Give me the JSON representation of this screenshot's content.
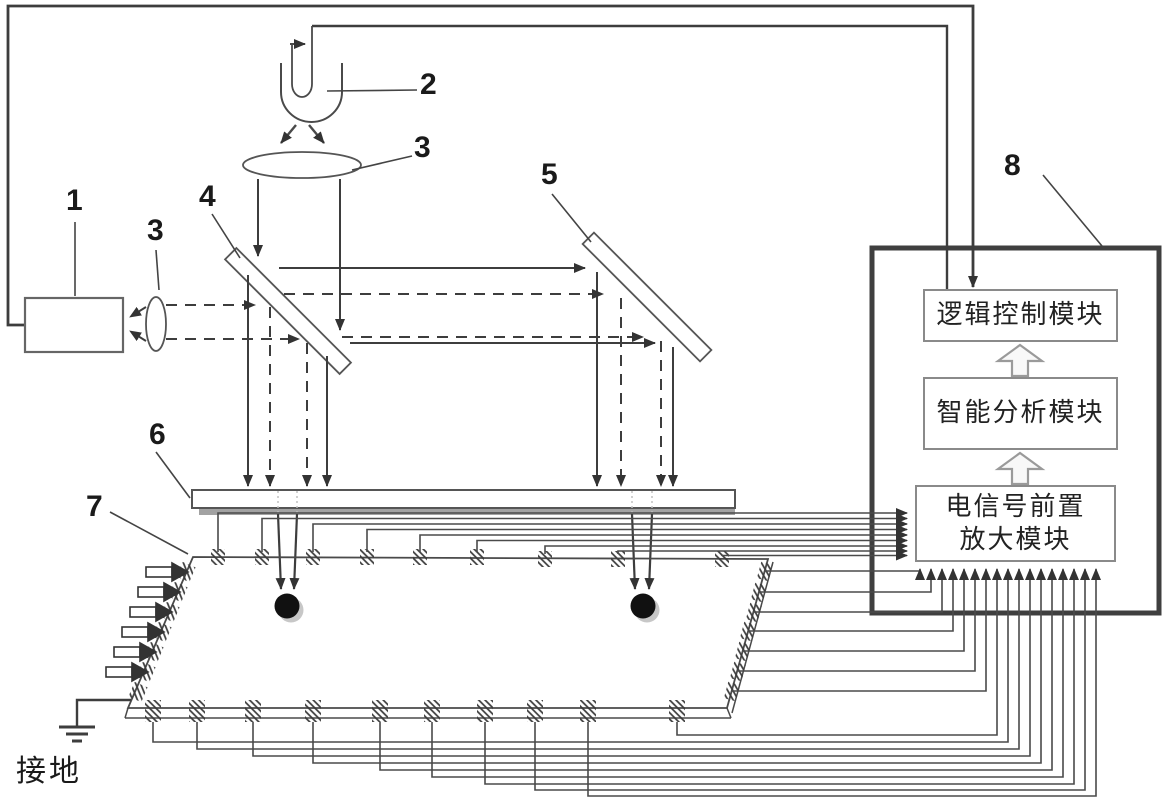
{
  "figure": {
    "background": "#ffffff",
    "line_color": "#3d3d3d",
    "dot_color": "#111111",
    "gray_strip_color": "#a2a2a2"
  },
  "ref_labels": {
    "n1": "1",
    "n2": "2",
    "n3_top": "3",
    "n3_left": "3",
    "n4": "4",
    "n5": "5",
    "n6": "6",
    "n7": "7",
    "n8": "8"
  },
  "controller": {
    "logic_module": "逻辑控制模块",
    "analysis_module": "智能分析模块",
    "preamp_module_line1": "电信号前置",
    "preamp_module_line2": "放大模块"
  },
  "ground_label": "接地"
}
